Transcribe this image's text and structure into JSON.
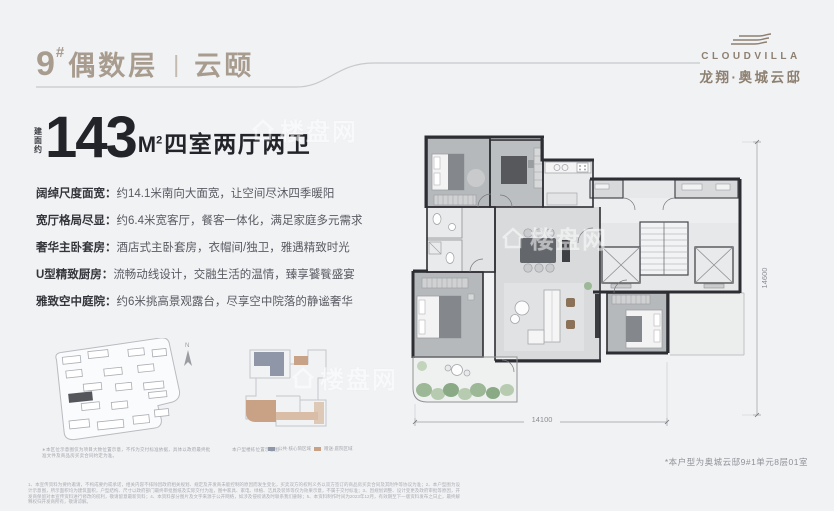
{
  "header": {
    "block_no": "9",
    "block_sup": "#",
    "floor": "偶数层",
    "divider": "丨",
    "name": "云颐"
  },
  "brand": {
    "en": "CLOUDVILLA",
    "cn": "龙翔·奥城云邸"
  },
  "headline": {
    "prefix_chars": [
      "建",
      "面",
      "约"
    ],
    "area": "143",
    "unit": "M",
    "unit_sup": "2",
    "layout": "四室两厅两卫"
  },
  "features": [
    {
      "label": "阔绰尺度面宽：",
      "desc": "约14.1米南向大面宽，让空间尽沐四季暖阳"
    },
    {
      "label": "宽厅格局尽显：",
      "desc": "约6.4米宽客厅，餐客一体化，满足家庭多元需求"
    },
    {
      "label": "奢华主卧套房：",
      "desc": "酒店式主卧套房，衣帽间/独卫，雅遇精致时光"
    },
    {
      "label": "U型精致厨房：",
      "desc": "流畅动线设计，交融生活的温情，臻享饕餮盛宴"
    },
    {
      "label": "雅致空中庭院：",
      "desc": "约6米挑高景观露台，尽享空中院落的静谧奢华"
    }
  ],
  "siteplan": {
    "north_label": "N",
    "caption": "∗本区位示意图仅为项目大致位置示意，不作为交付标准依据，具体以政府最终批准文件及商品房买卖合同约定为准。"
  },
  "keyplan": {
    "caption": "本户型楼栋位置示意图",
    "legend": [
      {
        "color": "#8e96a7",
        "label": "公共·核心筒区域"
      },
      {
        "color": "#c9a184",
        "label": "赠送·庭院区域"
      }
    ]
  },
  "plan": {
    "dim_width": "14100",
    "dim_height": "14600"
  },
  "watermark": {
    "text": "楼盘网"
  },
  "footnote": "*本户型为奥城云邸9#1单元8层01室",
  "disclaimer": "1、本宣传资料为要约邀请，不构成要约或承诺，相关内容不排除因政府相关规划、规定及开发商未能控制的原因而发生变化，买卖双方的权利义务以双方签订的商品房买卖合同及其附件等协议为准；2、本户型图为设计示意图，所示面积均为建筑面积，户型结构、尺寸以政府部门最终审批图纸及实际交付为准，图中家具、家电、绿植、洁具及装饰等仅为效果示意，不属于交付标准；3、因规划调整、设计变更及政府审批等原因，开发商保留对本宣传资料进行修改的权利，敬请留意最新资料；4、本资料部分图片及文字来源于公开网络，如涉及侵权请及时联系我们删除；5、本资料制作时间为2023年12月，有效期至下一版资料发布之日止，最终解释权归开发商所有，敬请谅解。",
  "colors": {
    "accent_taupe": "#a89c8f",
    "ink": "#232429",
    "body_text": "#595a62",
    "wall": "#2d2e33",
    "slate": "#8e96a7",
    "tan": "#c9a184"
  }
}
